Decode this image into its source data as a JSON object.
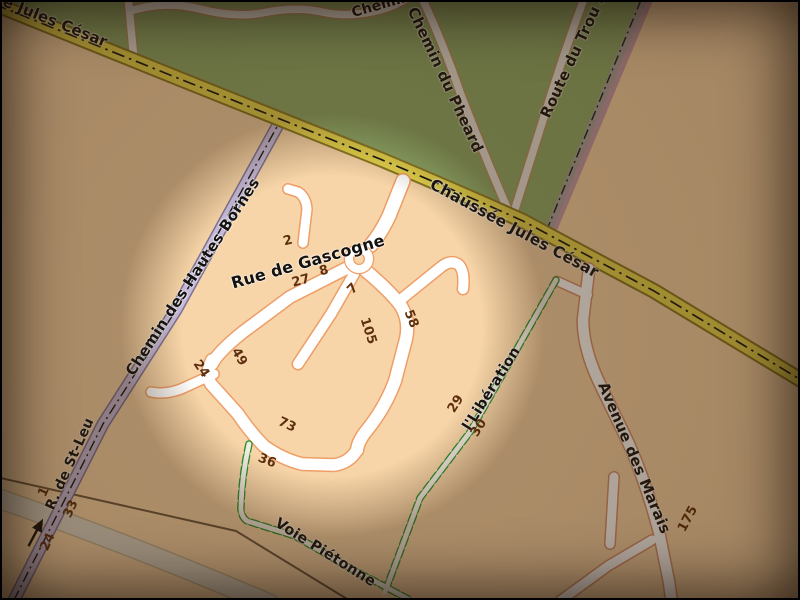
{
  "window": {
    "type": "map-view",
    "title": "Map with circular spotlight over housing estate"
  },
  "colors": {
    "highlight_peach": "#f7d5a8",
    "dim_overlay": "#3a2008",
    "green_area": "#8fae6d",
    "main_road_yellow": "#e8d84e",
    "residential_road_fill": "#ffffff",
    "residential_road_casing": "#ee9e66",
    "restricted_road_purple": "#c5bad8",
    "footpath_green": "#2f8f2f",
    "house_number_text": "#5f2f0e",
    "street_label_text": "#141210"
  },
  "map": {
    "highlight_circle": {
      "center_x": 332,
      "center_y": 326,
      "radius_px": 205
    },
    "street_labels": [
      {
        "id": "jules-cesar-partial",
        "text": "e Jules César",
        "x": 55,
        "y": 22,
        "rot": 22,
        "size": 15
      },
      {
        "id": "chemin-top-partial",
        "text": "Chemin",
        "x": 381,
        "y": 5,
        "rot": -16,
        "size": 14
      },
      {
        "id": "chemin-du-pheard",
        "text": "Chemin du Pheard",
        "x": 445,
        "y": 80,
        "rot": 65,
        "size": 15
      },
      {
        "id": "route-du-trou",
        "text": "Route du Trou a",
        "x": 574,
        "y": 55,
        "rot": -65,
        "size": 15
      },
      {
        "id": "chaussee-jules-cesar",
        "text": "Chaussée Jules César",
        "x": 514,
        "y": 229,
        "rot": 28.5,
        "size": 15.5
      },
      {
        "id": "chemin-des-hautes-bornes",
        "text": "Chemin des Hautes Bornes",
        "x": 193,
        "y": 277,
        "rot": -57,
        "size": 15
      },
      {
        "id": "rue-de-gascogne",
        "text": "Rue de Gascogne",
        "x": 308,
        "y": 262,
        "rot": -16,
        "size": 16
      },
      {
        "id": "rue-de-st-leu",
        "text": "R. de St-Leu",
        "x": 70,
        "y": 464,
        "rot": -66,
        "size": 14
      },
      {
        "id": "liberation",
        "text": "l'Libération",
        "x": 492,
        "y": 389,
        "rot": -58,
        "size": 14.5
      },
      {
        "id": "avenue-des-marais",
        "text": "Avenue des Marais",
        "x": 634,
        "y": 458,
        "rot": 67,
        "size": 15
      },
      {
        "id": "voie-pietonne",
        "text": "Voie Piétonne",
        "x": 325,
        "y": 553,
        "rot": 32,
        "size": 14.5
      }
    ],
    "house_numbers": [
      {
        "value": "2",
        "x": 288,
        "y": 241,
        "rot": -15
      },
      {
        "value": "27",
        "x": 301,
        "y": 281,
        "rot": -15
      },
      {
        "value": "8",
        "x": 324,
        "y": 271,
        "rot": -15
      },
      {
        "value": "7",
        "x": 353,
        "y": 289,
        "rot": -45
      },
      {
        "value": "105",
        "x": 368,
        "y": 331,
        "rot": 72
      },
      {
        "value": "58",
        "x": 411,
        "y": 319,
        "rot": 68
      },
      {
        "value": "49",
        "x": 239,
        "y": 357,
        "rot": 60
      },
      {
        "value": "24",
        "x": 201,
        "y": 369,
        "rot": 55
      },
      {
        "value": "73",
        "x": 287,
        "y": 425,
        "rot": 25
      },
      {
        "value": "36",
        "x": 267,
        "y": 461,
        "rot": 22
      },
      {
        "value": "29",
        "x": 456,
        "y": 404,
        "rot": -58
      },
      {
        "value": "30",
        "x": 479,
        "y": 428,
        "rot": -58
      },
      {
        "value": "1",
        "x": 44,
        "y": 492,
        "rot": -65
      },
      {
        "value": "33",
        "x": 71,
        "y": 509,
        "rot": -65
      },
      {
        "value": "24",
        "x": 48,
        "y": 542,
        "rot": -65
      },
      {
        "value": "175",
        "x": 688,
        "y": 519,
        "rot": -62
      }
    ],
    "icons": [
      {
        "id": "oneway-arrow",
        "meaning": "one-way direction arrow on R. de St-Leu"
      }
    ]
  }
}
